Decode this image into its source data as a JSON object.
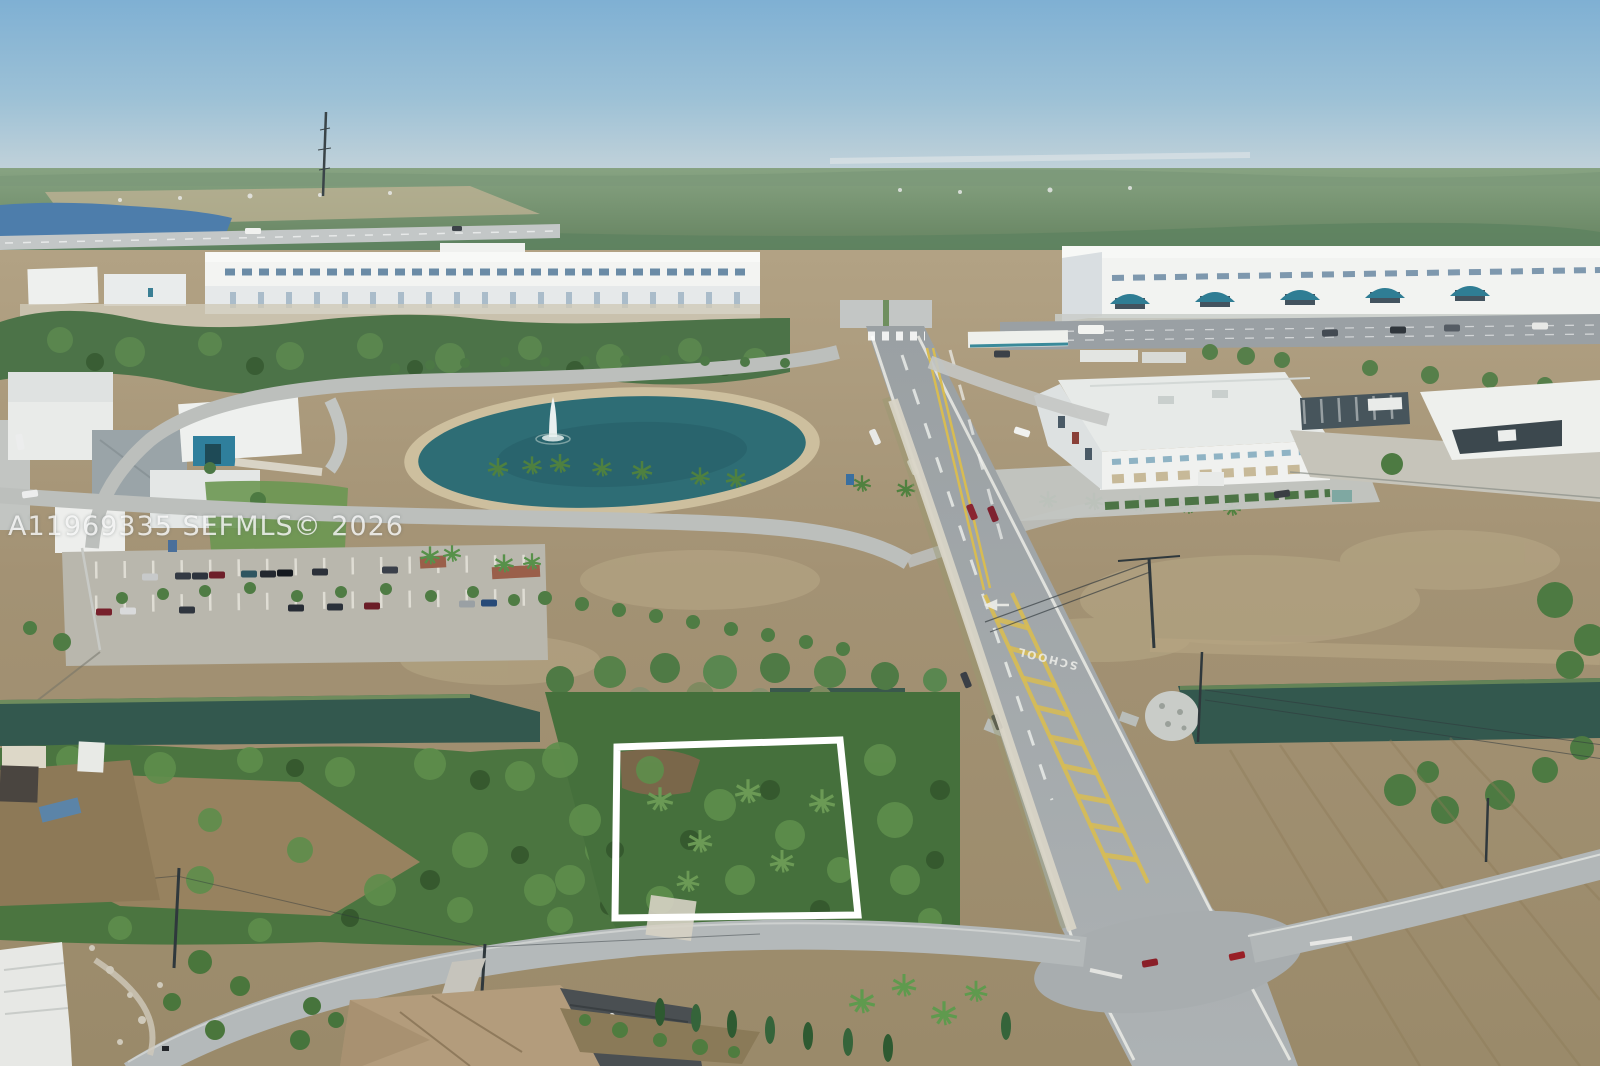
{
  "watermark": {
    "text": "A11969335 SEFMLS© 2026"
  },
  "road": {
    "pavement_marking": "SCHOOL"
  },
  "palette": {
    "sky_top": "#7fb0d3",
    "sky_horizon": "#c6d4da",
    "far_forest": "#6e8d6d",
    "distant_lake": "#4d7dab",
    "pond_water": "#2e6d75",
    "canal_water": "#33584e",
    "field_tan": "#a39274",
    "shrub_green": "#4b7540",
    "asphalt": "#9aa0a3",
    "concrete": "#c3c6c5",
    "warehouse_white": "#f2f3f1",
    "awning_teal": "#2f7d94",
    "school_arch_teal": "#2f7f9c",
    "lane_yellow": "#d8bc52",
    "property_outline": "#ffffff",
    "house_roof_tan": "#b39c7c"
  }
}
